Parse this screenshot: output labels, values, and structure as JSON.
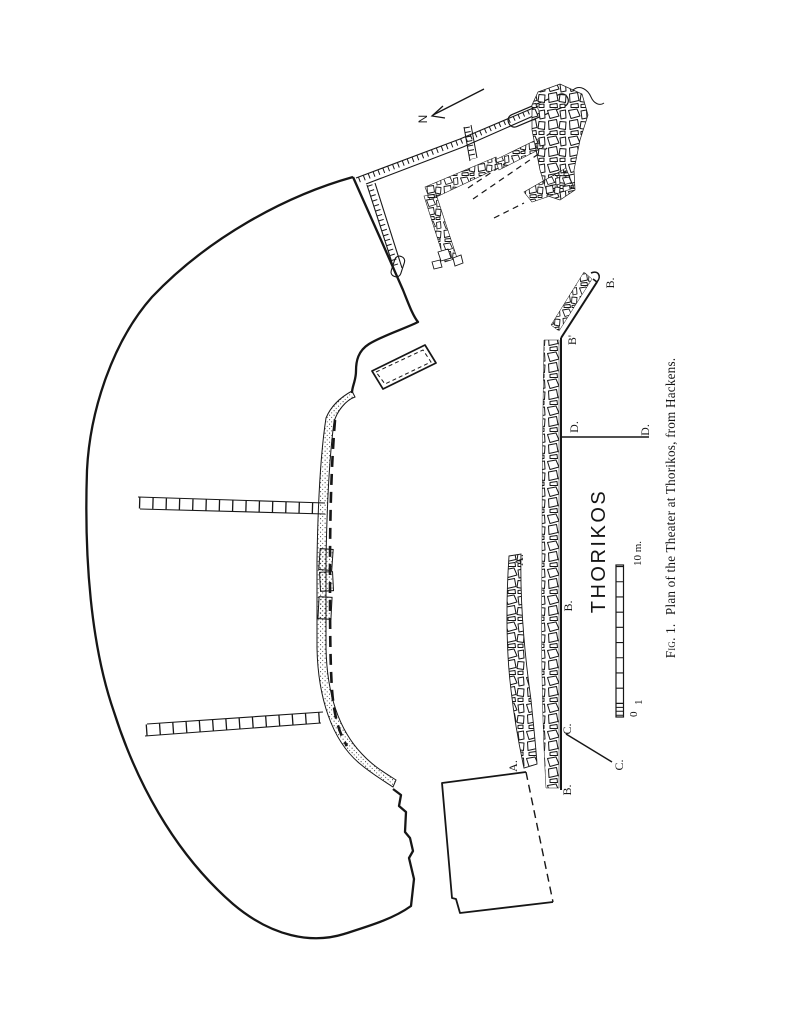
{
  "page": {
    "background": "#ffffff",
    "ink": "#161616"
  },
  "figure": {
    "caption_prefix": "Fig. 1.",
    "caption_rest": "Plan of the Theater at Thorikos, from Hackens.",
    "site_label": "THORIKOS",
    "north_label": "N"
  },
  "scale_bar": {
    "zero": "0",
    "one": "1",
    "ten": "10 m."
  },
  "plan_labels": [
    {
      "id": "b-top",
      "text": "B."
    },
    {
      "id": "b-prime",
      "text": "B'"
    },
    {
      "id": "d-left",
      "text": "D."
    },
    {
      "id": "d-right",
      "text": "D."
    },
    {
      "id": "a-top",
      "text": "A."
    },
    {
      "id": "b-mid",
      "text": "B."
    },
    {
      "id": "c-left",
      "text": "C."
    },
    {
      "id": "c-right",
      "text": "C."
    },
    {
      "id": "a-bottom",
      "text": "A."
    },
    {
      "id": "b-bottom",
      "text": "B."
    }
  ]
}
